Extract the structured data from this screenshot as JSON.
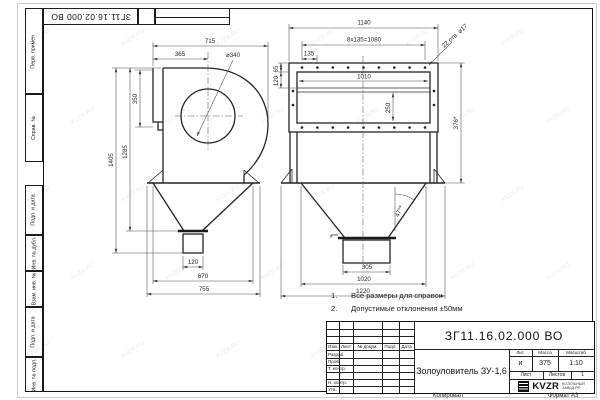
{
  "watermark": "KVZR.RU",
  "margin_labels": [
    "Перв. примен.",
    "Справ. №",
    "Подп. и дата",
    "Инв. № дубл.",
    "Взам. инв. №",
    "Подп. и дата",
    "Инв. № подл."
  ],
  "notes": [
    {
      "num": "1.",
      "text": "Все размеры для справок"
    },
    {
      "num": "2.",
      "text": "Допустимые отклонения ±50мм"
    }
  ],
  "left_view": {
    "dim_715": "715",
    "dim_365": "365",
    "dia_340": "⌀340",
    "dim_350": "350",
    "dim_1405": "1405",
    "dim_1285": "1285",
    "dim_120": "120",
    "dim_670": "670",
    "dim_755": "755"
  },
  "front_view": {
    "dim_1140": "1140",
    "dim_bolt_spacing": "8x135=1080",
    "dim_135": "135",
    "dim_1010": "1010",
    "dim_250": "250",
    "dim_65": "65",
    "dim_120": "120",
    "leader_holes": "22 отв. ⌀17",
    "dim_376": "376*",
    "angle": "47°*",
    "dim_305": "305",
    "dim_1020": "1020",
    "dim_1220": "1220"
  },
  "title_block": {
    "doc_number": "ЗГ11.16.02.000 ВО",
    "product_name": "Золоуловитель ЗУ-1,6",
    "grid_headers": [
      "Изм.",
      "Лист",
      "№ докум.",
      "Подп.",
      "Дата"
    ],
    "grid_rows": [
      "Разраб.",
      "Пров.",
      "Т. контр.",
      "",
      "Н. контр.",
      "Утв."
    ],
    "litera_label": "Лит.",
    "mass_label": "Масса",
    "scale_label": "Масштаб",
    "litera_value": "и",
    "mass_value": "375",
    "scale_value": "1:10",
    "sheet_label": "Лист",
    "sheets_label": "Листов",
    "sheets_value": "1",
    "logo_text": "KVZR",
    "logo_sub_line1": "КОТЕЛЬНЫЙ",
    "logo_sub_line2": "ЗАВОД.РФ",
    "copied_label": "Копировал",
    "format_label": "Формат А3"
  }
}
